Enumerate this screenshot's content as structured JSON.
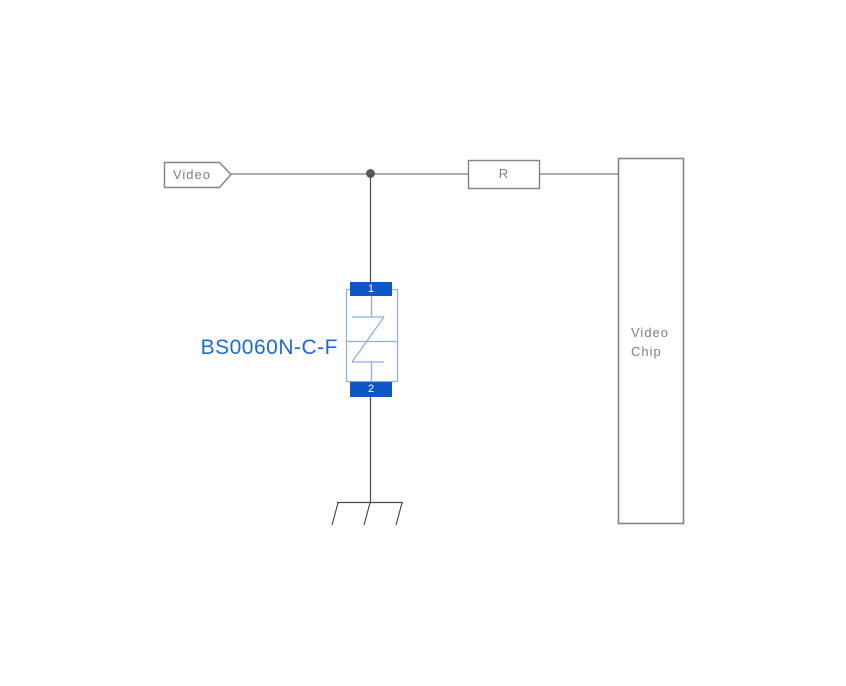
{
  "diagram": {
    "input_tag": {
      "label": "Video"
    },
    "resistor": {
      "label": "R"
    },
    "chip": {
      "label_line1": "Video",
      "label_line2": "Chip"
    },
    "protection_device": {
      "label": "BS0060N-C-F",
      "pin_top": "1",
      "pin_bottom": "2",
      "symbol": "bidirectional-tvs-diode"
    },
    "ground": {
      "symbol": "chassis-ground"
    }
  },
  "colors": {
    "wire_gray": "#8f8f8f",
    "wire_dark": "#4c4c4c",
    "box_border": "#838383",
    "text_gray": "#7f7f7f",
    "pad_blue": "#0d57c6",
    "symbol_blue": "#8aafdf",
    "label_blue": "#1a6ad4",
    "junction_dot": "#595959",
    "background": "#ffffff"
  }
}
